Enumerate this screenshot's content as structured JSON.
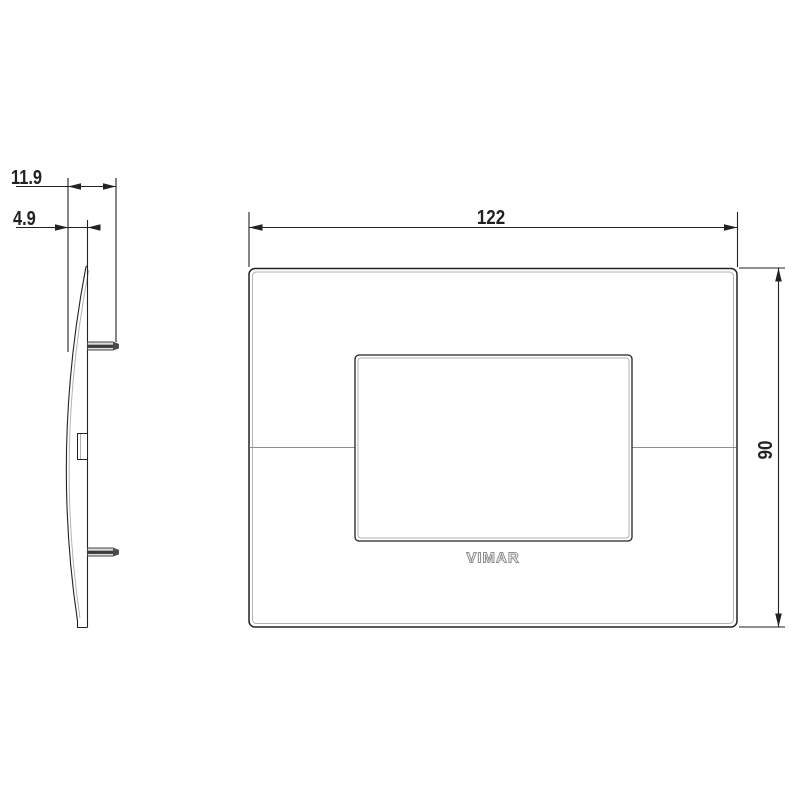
{
  "drawing": {
    "type": "technical-dimension-drawing",
    "brand": "VIMAR",
    "side_view": {
      "dim_total_depth": "11.9",
      "dim_plate_depth": "4.9"
    },
    "front_view": {
      "dim_width": "122",
      "dim_height": "90",
      "logo": "VIMAR"
    },
    "colors": {
      "line": "#222222",
      "secondary_line": "#b3b3b3",
      "seam_line": "#8f8f8f",
      "clip_dark": "#3c3c3c",
      "clip_light": "#dcdcdc",
      "logo_outline": "#8d8d8d",
      "background": "#ffffff"
    }
  }
}
